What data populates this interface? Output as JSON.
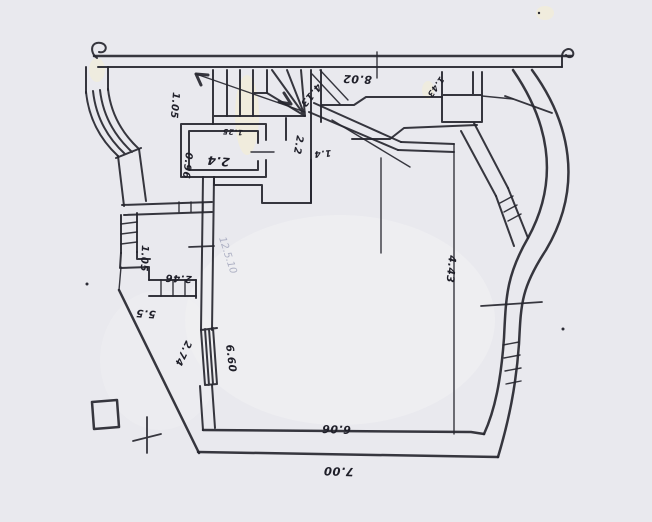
{
  "document": {
    "title": "hand-drawn floor plan sketch"
  },
  "colors": {
    "paper": "#e9e9ee",
    "ink": "#26262f",
    "pencil": "#7b80a0",
    "stain": "#f5efcf"
  },
  "annotations": {
    "upper_hall_width": "1.05",
    "wc_width": "0.96",
    "wc_label": "2.4",
    "wc_door": "1.25",
    "stair_hall": "2.2",
    "stair_hall_small": "1.4",
    "top_corridor_length": "8.02",
    "top_diagonal": "4.13",
    "shaft_width": "1.43",
    "room_right_depth": "4.43",
    "left_hall_width": "1.05",
    "left_hall_length": "2.46",
    "left_wall": "5.5",
    "window_lower_left": "2.74",
    "room_left_depth": "6.60",
    "room_bottom_width": "6.06",
    "overall_bottom_width": "7.00",
    "handwritten_note": "12.5.10"
  }
}
